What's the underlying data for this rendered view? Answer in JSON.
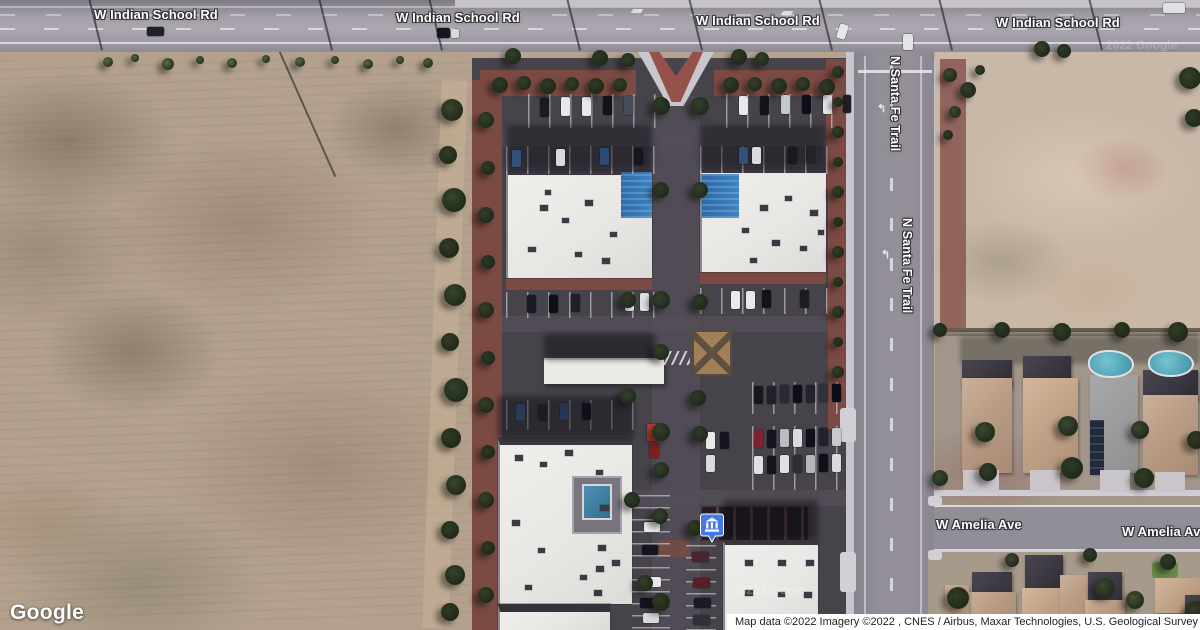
{
  "map": {
    "road_labels": {
      "indian_school_1": "W Indian School Rd",
      "indian_school_2": "W Indian School Rd",
      "indian_school_3": "W Indian School Rd",
      "indian_school_4": "W Indian School Rd",
      "santa_fe_1": "N Santa Fe Trail",
      "santa_fe_2": "N Santa Fe Trail",
      "amelia_1": "W Amelia Ave",
      "amelia_2": "W Amelia Ave"
    },
    "watermarks": {
      "imagery_1": "2022 Google",
      "imagery_2": "2022 Google"
    },
    "poi": {
      "icon": "bank-icon",
      "color": "#4779e2"
    },
    "branding": {
      "logo_text": "Google"
    },
    "attribution": {
      "text": "Map data ©2022 Imagery ©2022 , CNES / Airbus, Maxar Technologies, U.S. Geological Survey"
    },
    "colors": {
      "label_text": "#ffffff",
      "attribution_bg": "#ffffff",
      "attribution_text": "#1f1f1f",
      "poi_blue": "#4779e2",
      "roof_blue": "#3579b8",
      "pool_teal": "#4f9fae",
      "asphalt": "#47434b",
      "dirt_field": "#b3a18e"
    }
  }
}
